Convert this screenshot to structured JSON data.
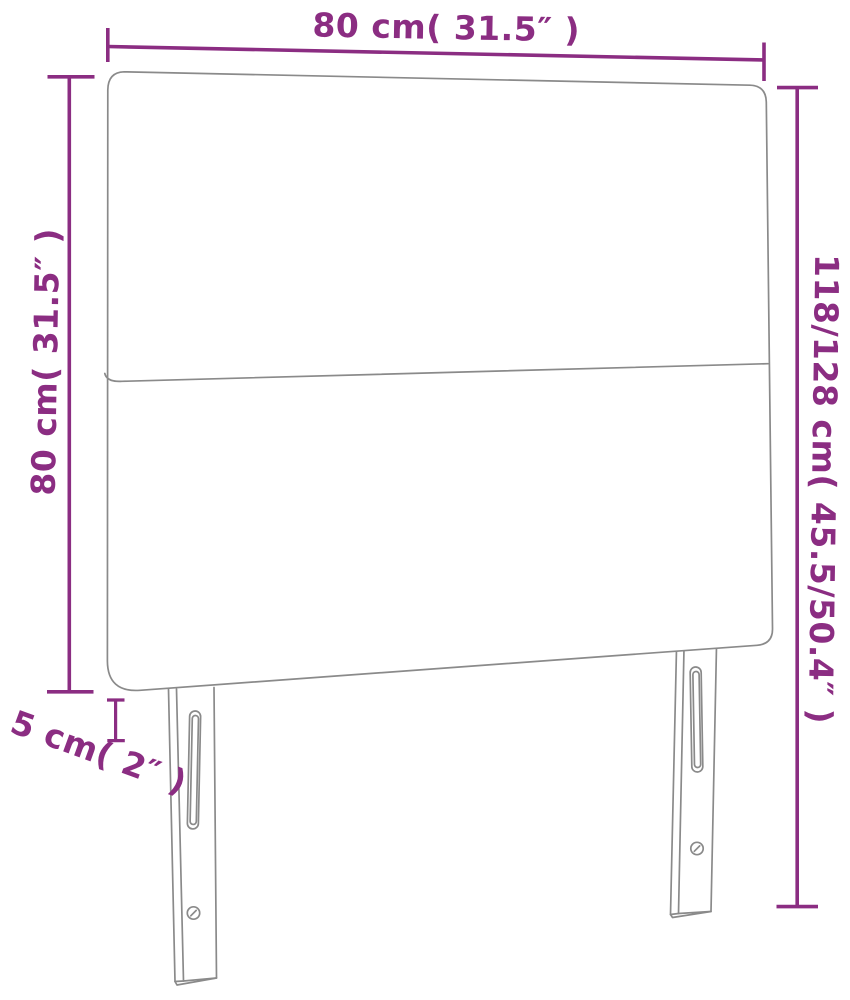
{
  "diagram": {
    "name": "headboard-dimensions-diagram",
    "colors": {
      "dimension_lines": "#8b2d82",
      "label_text": "#8b2d82",
      "product_outline": "#8a8a8a",
      "background": "#ffffff"
    },
    "labels": {
      "top_width": "80 cm( 31.5″ )",
      "left_height": "80 cm( 31.5″ )",
      "right_height_range": "118/128 cm( 45.5/50.4″ )",
      "depth": "5 cm( 2″ )"
    },
    "dimensions": {
      "width_cm": "80",
      "width_inch": "31.5",
      "panel_height_cm": "80",
      "panel_height_inch": "31.5",
      "total_height_cm": "118/128",
      "total_height_inch": "45.5/50.4",
      "depth_cm": "5",
      "depth_inch": "2"
    }
  }
}
